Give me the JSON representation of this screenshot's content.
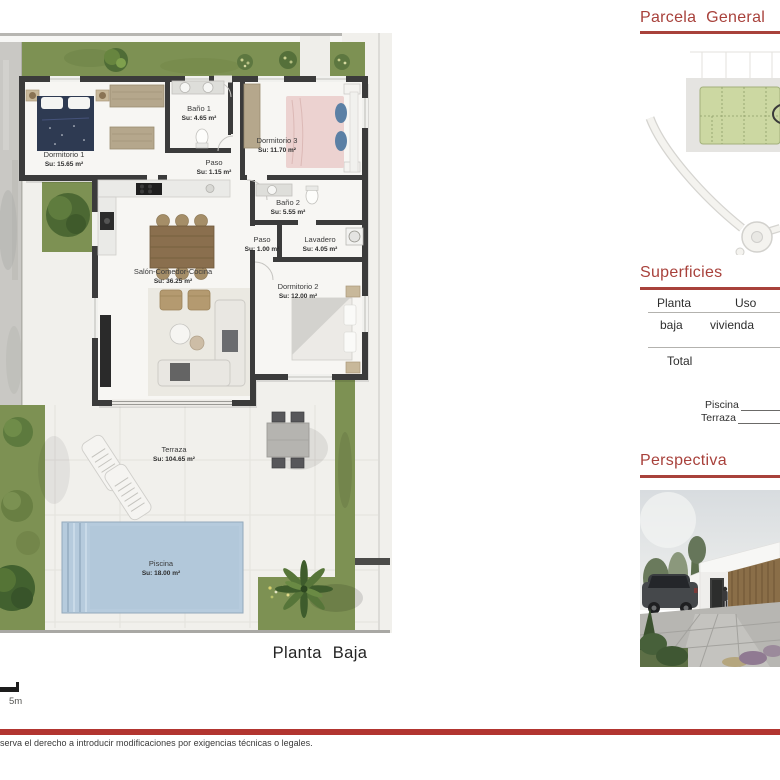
{
  "page": {
    "plan_title": "Planta Baja",
    "scale_label": "5m"
  },
  "floorplan": {
    "rooms": [
      {
        "name": "Dormitorio 1",
        "area": "Su: 15.65 m²"
      },
      {
        "name": "Baño 1",
        "area": "Su: 4.65 m²"
      },
      {
        "name": "Dormitorio 3",
        "area": "Su: 11.70 m²"
      },
      {
        "name": "Paso",
        "area": "Su: 1.15 m²"
      },
      {
        "name": "Baño 2",
        "area": "Su: 5.55 m²"
      },
      {
        "name": "Paso",
        "area": "Su: 1.00 m²"
      },
      {
        "name": "Lavadero",
        "area": "Su: 4.05 m²"
      },
      {
        "name": "Salón-Comedor-Cocina",
        "area": "Su: 36.25 m²"
      },
      {
        "name": "Dormitorio 2",
        "area": "Su: 12.00 m²"
      },
      {
        "name": "Terraza",
        "area": "Su: 104.65 m²"
      },
      {
        "name": "Piscina",
        "area": "Su: 18.00 m²"
      }
    ]
  },
  "sidebar": {
    "parcela": {
      "title": "Parcela General"
    },
    "superficies": {
      "title": "Superficies",
      "col_planta": "Planta",
      "col_uso": "Uso",
      "row_planta": "baja",
      "row_uso": "vivienda",
      "total_label": "Total",
      "piscina_label": "Piscina",
      "terraza_label": "Terraza"
    },
    "perspectiva": {
      "title": "Perspectiva"
    }
  },
  "footer": {
    "disclaimer": "serva el derecho a introducir modificaciones por exigencias técnicas o legales."
  },
  "colors": {
    "accent_red": "#a8413b",
    "footer_red": "#b23530",
    "grass_green": "#7d9153",
    "pool_blue": "#b6cbdd",
    "wall_dark": "#3b3b3b"
  }
}
